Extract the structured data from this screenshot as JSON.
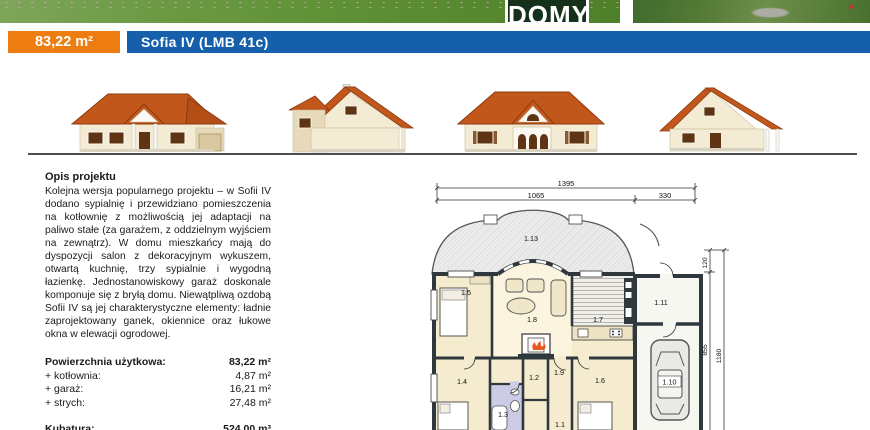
{
  "header": {
    "logo_text": "DOMY",
    "area_badge": "83,22 m²",
    "title": "Sofia IV (LMB 41c)",
    "colors": {
      "badge_bg": "#EE7D11",
      "title_bg": "#1660AB",
      "roof": "#C2571C",
      "wall": "#F3EBD3"
    }
  },
  "description": {
    "heading": "Opis projektu",
    "body": "Kolejna wersja popularnego projektu – w Sofii IV dodano sypialnię i przewidziano pomieszczenia na kotłownię z możliwością jej adaptacji na paliwo stałe (za garażem, z oddzielnym wyjściem na zewnątrz). W domu mieszkańcy mają do dyspozycji salon z dekoracyjnym wykuszem, otwartą kuchnię, trzy sypialnie i wygodną łazienkę. Jednostanowiskowy garaż doskonale komponuje się z bryłą domu. Niewątpliwą ozdobą Sofii IV są jej charakterystyczne elementy: ładnie zaprojektowany ganek, okiennice oraz łukowe okna w elewacji ogrodowej."
  },
  "areas": {
    "title_label": "Powierzchnia użytkowa:",
    "title_value": "83,22 m²",
    "rows": [
      {
        "label": "+ kotłownia:",
        "value": "4,87 m²"
      },
      {
        "label": "+ garaż:",
        "value": "16,21 m²"
      },
      {
        "label": "+ strych:",
        "value": "27,48 m²"
      }
    ],
    "kubatura_label": "Kubatura:",
    "kubatura_value": "524,00 m³"
  },
  "floor_plan": {
    "dims": {
      "top_total": "1395",
      "top_left": "1065",
      "top_right": "330",
      "right_offset": "120",
      "right_inner": "855",
      "right_outer": "1180"
    },
    "room_labels": {
      "r113": "1.13",
      "r15": "1.5",
      "r18": "1.8",
      "r17": "1.7",
      "r111": "1.11",
      "r110": "1.10",
      "r14": "1.4",
      "r19": "1.9",
      "r12": "1.2",
      "r13": "1.3",
      "r11": "1.1",
      "r16": "1.6"
    }
  }
}
